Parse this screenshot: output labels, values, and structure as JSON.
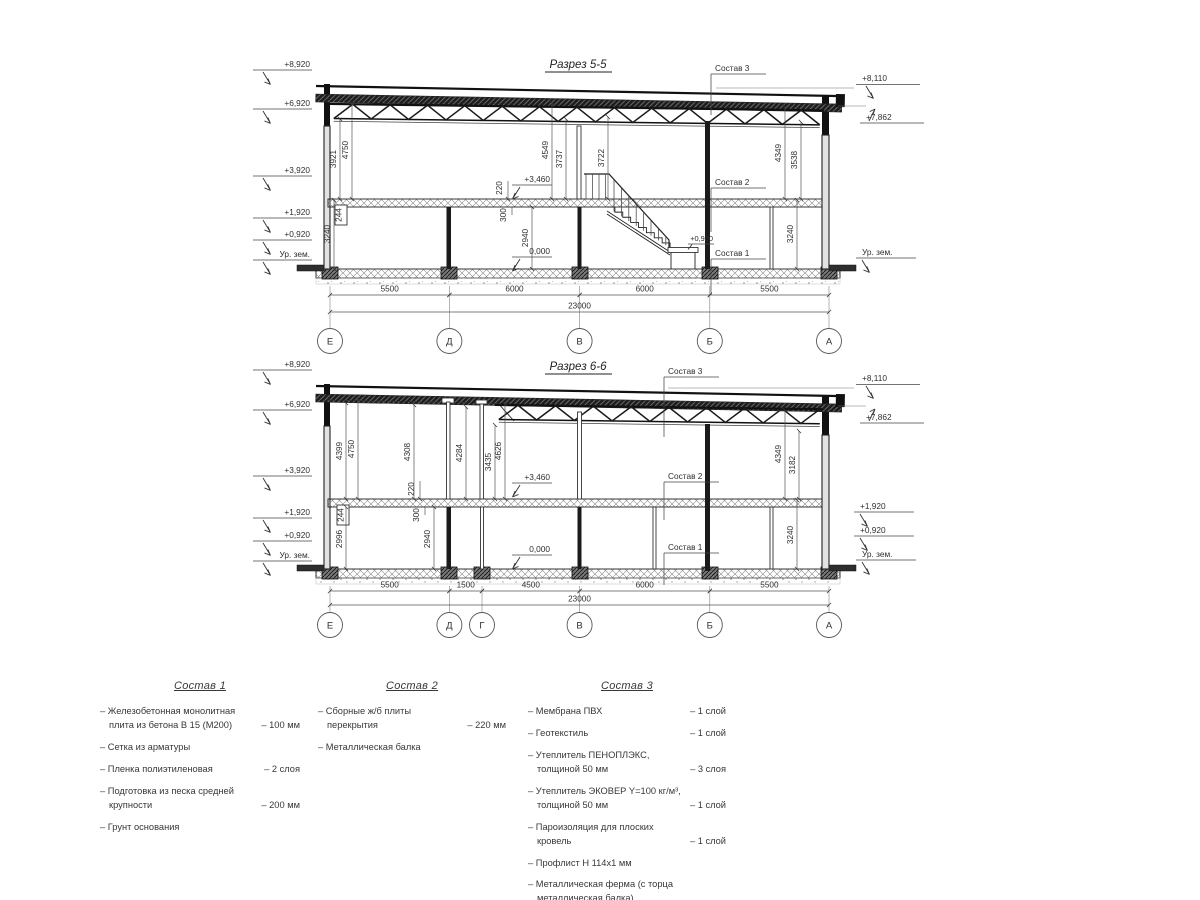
{
  "sections": [
    {
      "title": "Разрез 5-5",
      "left_elevations": [
        "+8,920",
        "+6,920",
        "+3,920",
        "+1,920",
        "+0,920",
        "Ур. зем."
      ],
      "right_elevations": [
        "+8,110",
        "+7,862",
        "Ур. зем."
      ],
      "vertical_dims": [
        "4750",
        "3921",
        "4549",
        "3737",
        "3722",
        "4349",
        "3538",
        "220",
        "244",
        "300",
        "3240",
        "2940",
        "3240"
      ],
      "level_marks": [
        "+3,460",
        "0,000",
        "+0,900"
      ],
      "callouts": [
        "Состав 3",
        "Состав 2",
        "Состав 1"
      ],
      "bottom_dims": [
        "5500",
        "6000",
        "6000",
        "5500"
      ],
      "total_dim": "23000",
      "axes": [
        "Е",
        "Д",
        "В",
        "Б",
        "А"
      ]
    },
    {
      "title": "Разрез 6-6",
      "left_elevations": [
        "+8,920",
        "+6,920",
        "+3,920",
        "+1,920",
        "+0,920",
        "Ур. зем."
      ],
      "right_elevations": [
        "+8,110",
        "+7,862",
        "+1,920",
        "+0,920",
        "Ур. зем."
      ],
      "vertical_dims": [
        "4750",
        "4399",
        "4308",
        "4284",
        "3435",
        "4626",
        "4349",
        "3182",
        "220",
        "244",
        "300",
        "2996",
        "2940",
        "3240"
      ],
      "level_marks": [
        "+3,460",
        "0,000"
      ],
      "callouts": [
        "Состав 3",
        "Состав 2",
        "Состав 1"
      ],
      "bottom_dims": [
        "5500",
        "1500",
        "4500",
        "6000",
        "5500"
      ],
      "total_dim": "23000",
      "axes": [
        "Е",
        "Д",
        "Г",
        "В",
        "Б",
        "А"
      ]
    }
  ],
  "legends": [
    {
      "title": "Состав 1",
      "items": [
        {
          "name": "Железобетонная  монолитная плита из бетона В 15 (М200)",
          "value": "– 100 мм"
        },
        {
          "name": "Сетка из арматуры",
          "value": ""
        },
        {
          "name": "Пленка полиэтиленовая",
          "value": "– 2 слоя"
        },
        {
          "name": "Подготовка из песка средней крупности",
          "value": "– 200 мм"
        },
        {
          "name": "Грунт основания",
          "value": ""
        }
      ]
    },
    {
      "title": "Состав 2",
      "items": [
        {
          "name": "Сборные ж/б плиты перекрытия",
          "value": "– 220 мм"
        },
        {
          "name": "Металлическая балка",
          "value": ""
        }
      ]
    },
    {
      "title": "Состав 3",
      "items": [
        {
          "name": "Мембрана ПВХ",
          "value": "– 1 слой"
        },
        {
          "name": "Геотекстиль",
          "value": "– 1 слой"
        },
        {
          "name": "Утеплитель ПЕНОПЛЭКС, толщиной 50 мм",
          "value": "– 3 слоя"
        },
        {
          "name": "Утеплитель ЭКОВЕР Y=100 кг/м³, толщиной 50 мм",
          "value": "– 1 слой"
        },
        {
          "name": "Пароизоляция для плоских кровель",
          "value": "– 1 слой"
        },
        {
          "name": "Профлист Н 114х1 мм",
          "value": ""
        },
        {
          "name": "Металлическая ферма (с торца металлическая балка)",
          "value": ""
        }
      ]
    }
  ]
}
